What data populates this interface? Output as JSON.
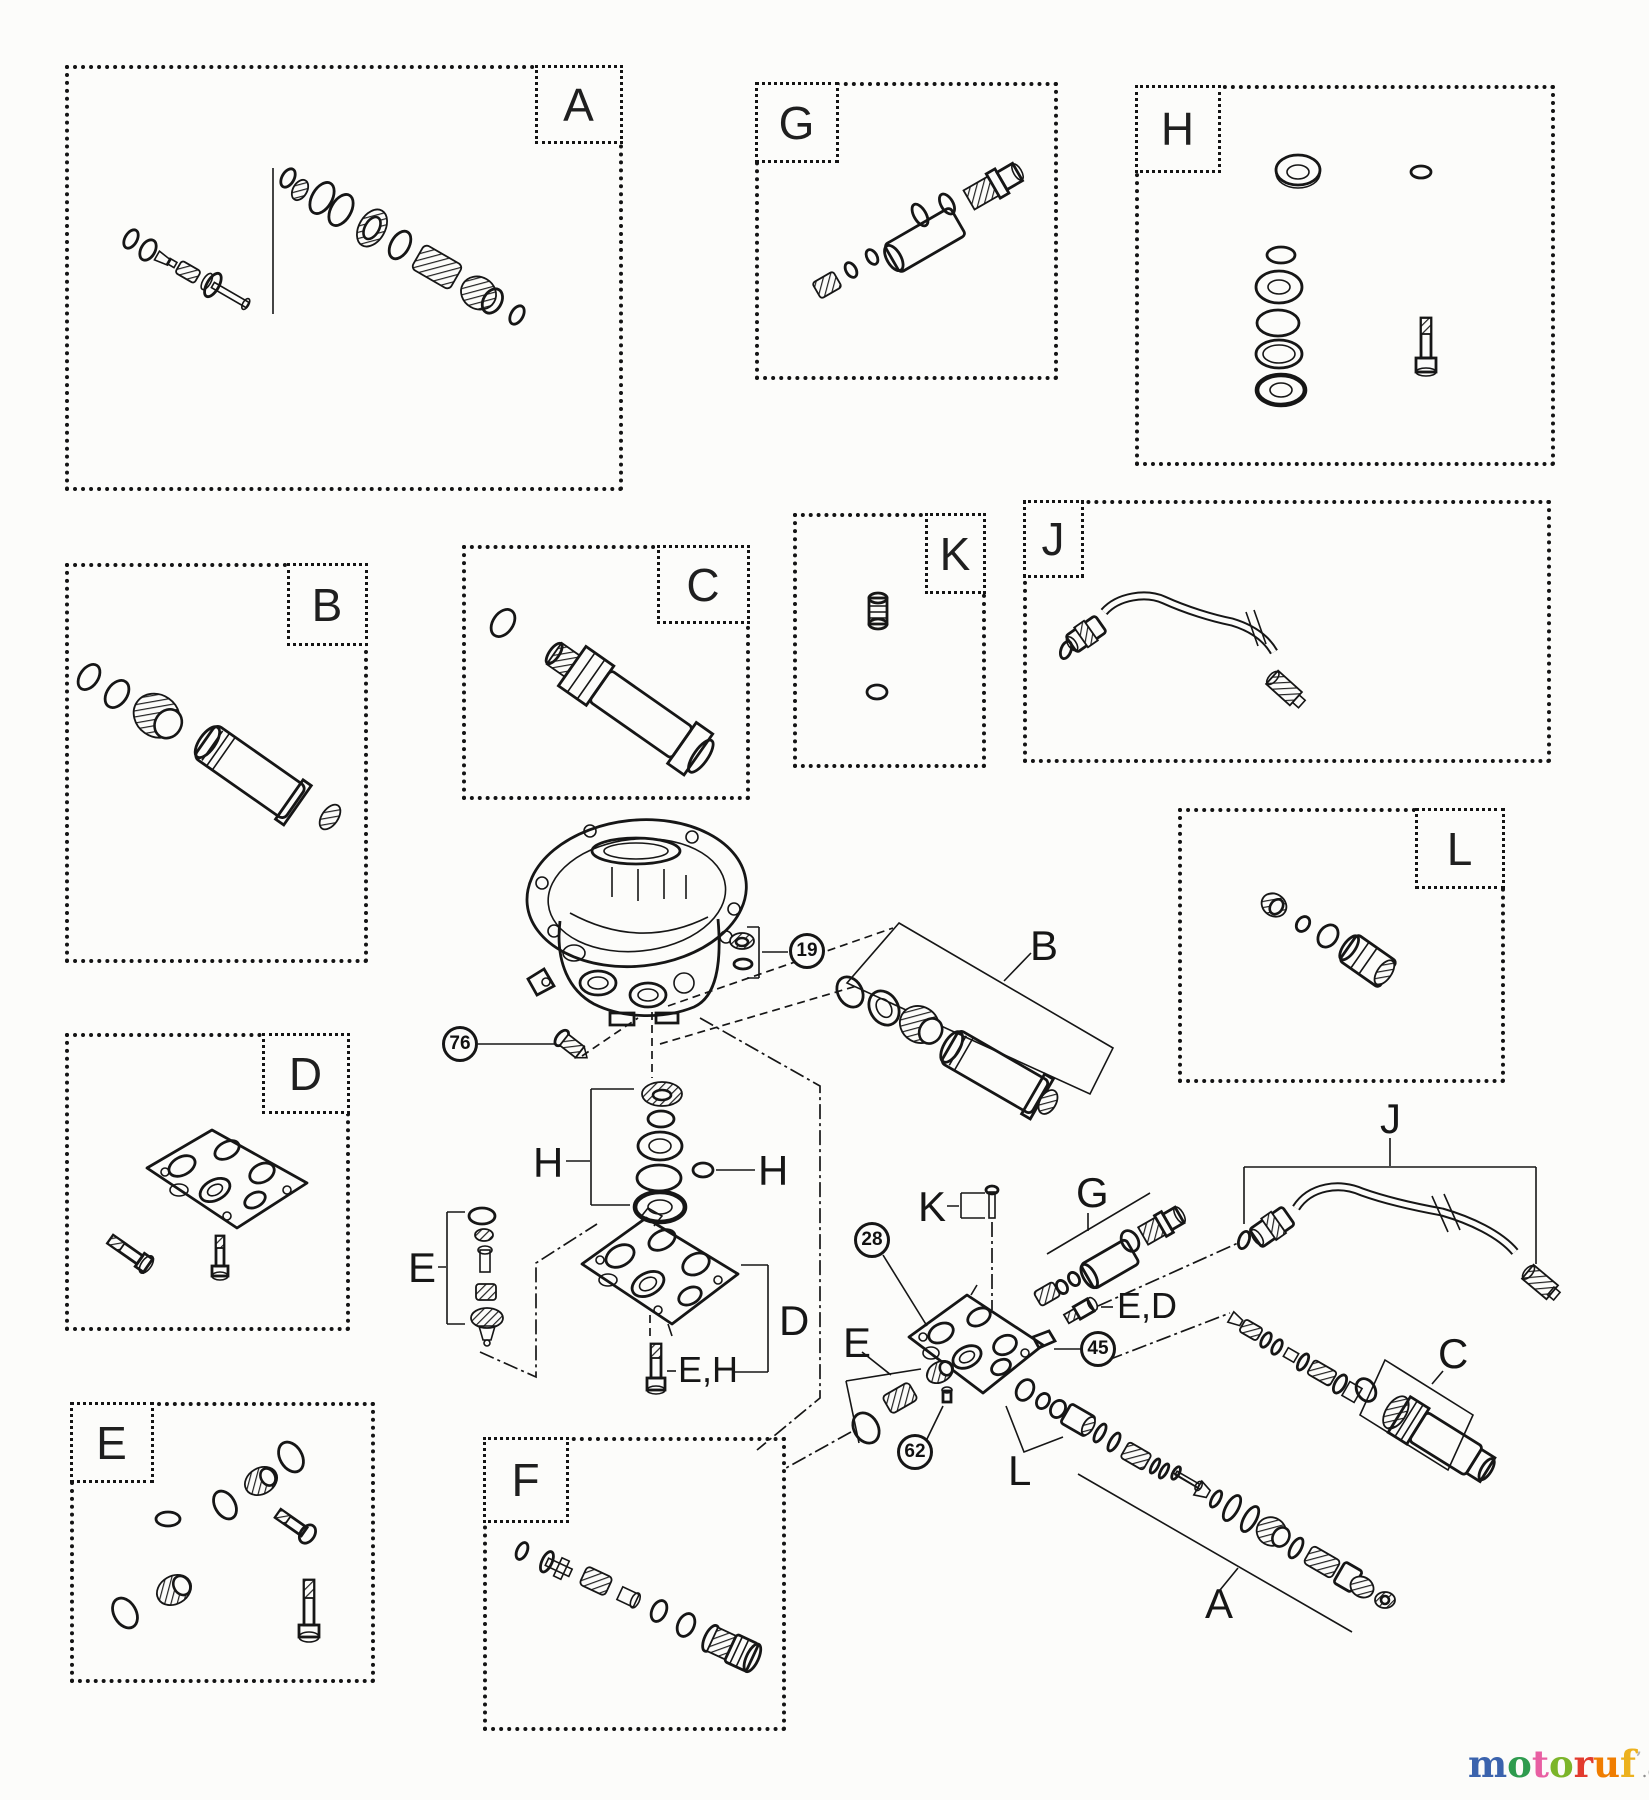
{
  "canvas": {
    "background": "#fcfcfa",
    "line_color": "#161616"
  },
  "boxes": {
    "a": "A",
    "b": "B",
    "c": "C",
    "d": "D",
    "e": "E",
    "f": "F",
    "g": "G",
    "h": "H",
    "j": "J",
    "k": "K",
    "l": "L"
  },
  "callouts": {
    "n19": "19",
    "n76": "76",
    "n28": "28",
    "n45": "45",
    "n62": "62"
  },
  "labels": {
    "b": "B",
    "h_left": "H",
    "h_right": "H",
    "e_left": "E",
    "d": "D",
    "eh": "E,H",
    "k": "K",
    "g": "G",
    "ed": "E,D",
    "e_lower": "E",
    "l": "L",
    "a": "A",
    "c": "C",
    "j": "J"
  },
  "watermark": {
    "letters": [
      {
        "char": "m",
        "color": "#3b63ad"
      },
      {
        "char": "o",
        "color": "#2e9b4e"
      },
      {
        "char": "t",
        "color": "#e85fa2"
      },
      {
        "char": "o",
        "color": "#7cb52a"
      },
      {
        "char": "r",
        "color": "#e23b2e"
      },
      {
        "char": "u",
        "color": "#f07d00"
      },
      {
        "char": "f",
        "color": "#ecb11e"
      }
    ],
    "tick": "’",
    "tick_color": "#b5b5b5",
    "suffix": ".de",
    "suffix_color": "#8d8d8d"
  }
}
